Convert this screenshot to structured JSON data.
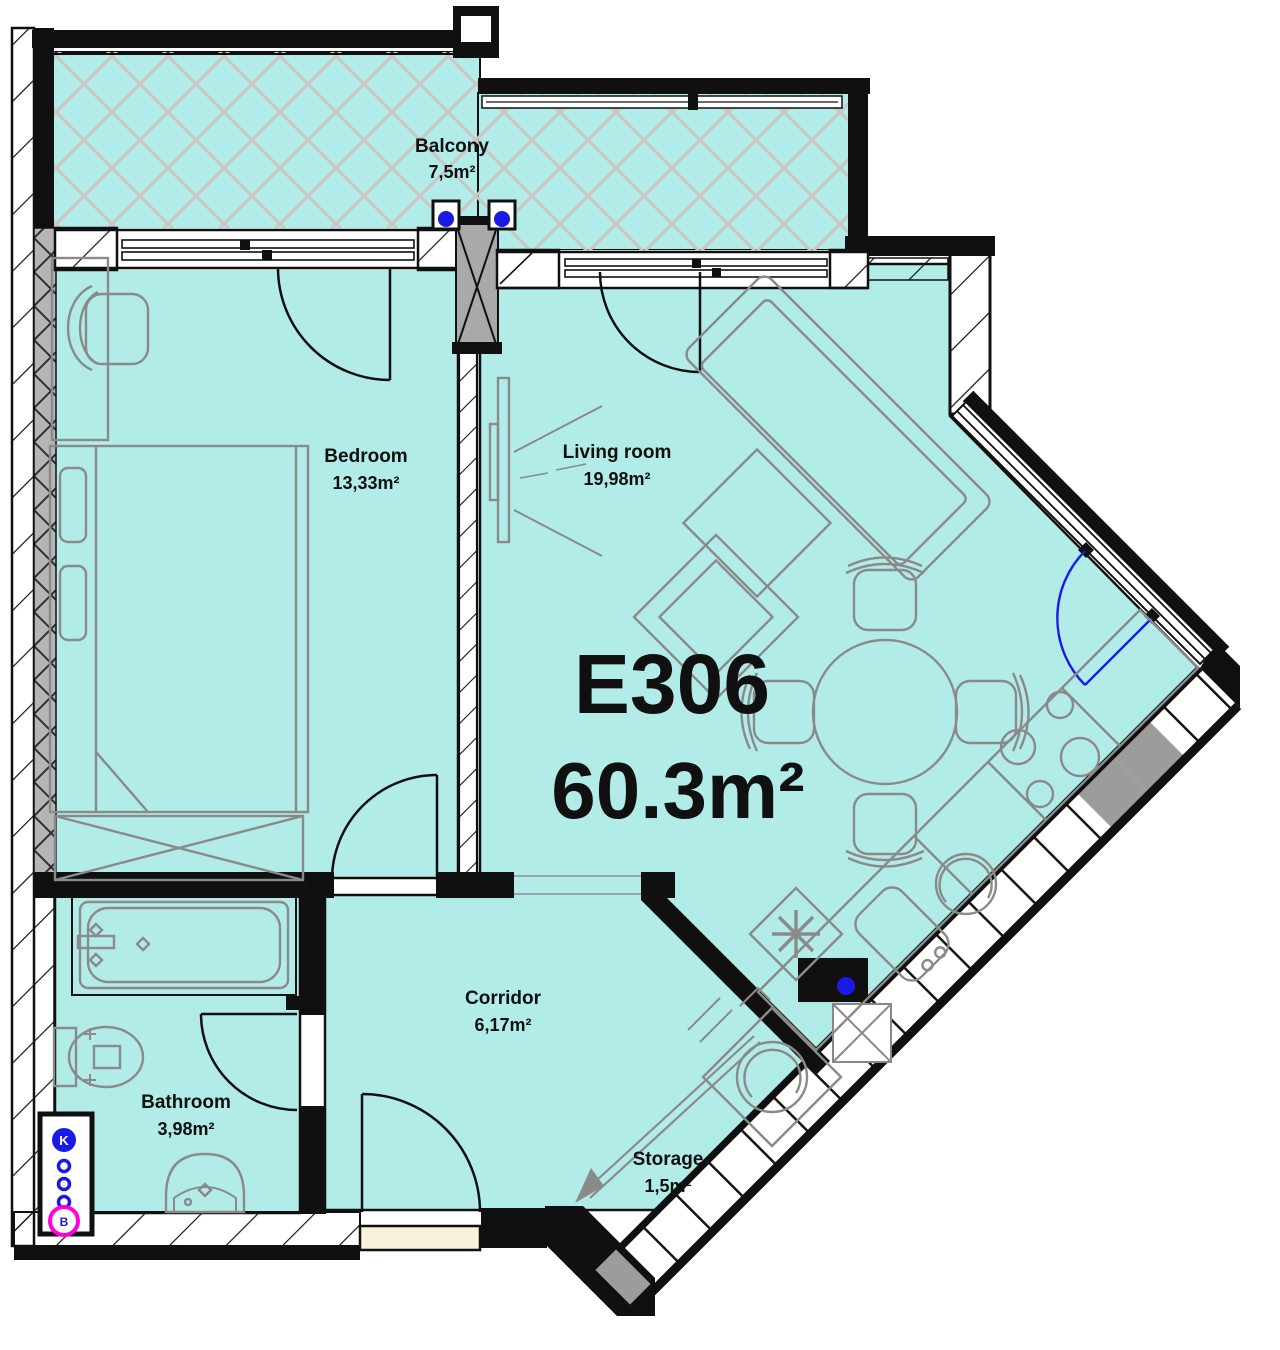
{
  "plan": {
    "unit": {
      "id": "E306",
      "area": "60.3m²"
    },
    "rooms": [
      {
        "id": "balcony",
        "name": "Balcony",
        "area": "7,5m²"
      },
      {
        "id": "bedroom",
        "name": "Bedroom",
        "area": "13,33m²"
      },
      {
        "id": "living",
        "name": "Living room",
        "area": "19,98m²"
      },
      {
        "id": "corridor",
        "name": "Corridor",
        "area": "6,17m²"
      },
      {
        "id": "bathroom",
        "name": "Bathroom",
        "area": "3,98m²"
      },
      {
        "id": "storage",
        "name": "Storage",
        "area": "1,5m²"
      }
    ],
    "risers": {
      "top": "K",
      "bottom": "B"
    },
    "colors": {
      "floor": "#b2ece8",
      "walls": "#101010",
      "furniture_outline": "#8a8a8a",
      "balcony_hatch": "#cdc6c2",
      "plumbing_blue": "#1a1ae6",
      "riser_magenta": "#ff00dd",
      "threshold_cream": "#f7f3da",
      "wall_fill_gray": "#b5b5b5"
    }
  }
}
